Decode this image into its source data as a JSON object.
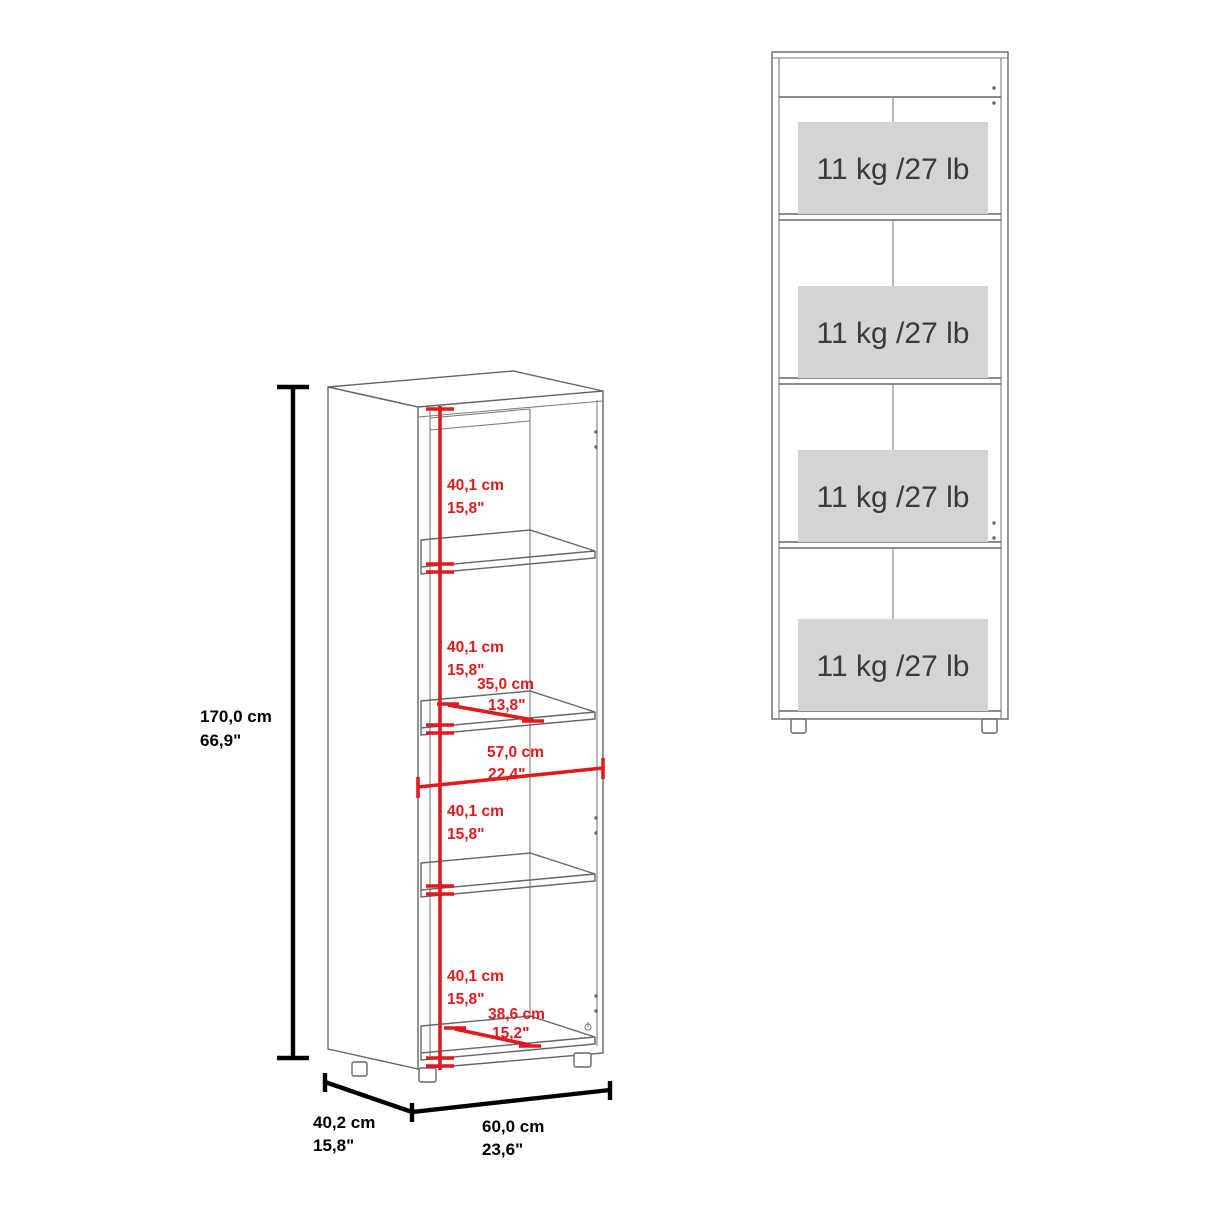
{
  "document": {
    "type": "furniture-dimension-diagram",
    "product": "4-shelf bookcase"
  },
  "colors": {
    "dimension_red": "#e2191d",
    "drawing_line_gray": "#63666a",
    "dimension_black": "#000000",
    "capacity_box_gray": "#d4d4d4",
    "capacity_text_gray": "#3a3a3a",
    "background": "#ffffff"
  },
  "iso": {
    "height_cm": "170,0 cm",
    "height_in": "66,9\"",
    "depth_cm": "40,2 cm",
    "depth_in": "15,8\"",
    "width_cm": "60,0 cm",
    "width_in": "23,6\"",
    "comp1_cm": "40,1 cm",
    "comp1_in": "15,8\"",
    "comp2_cm": "40,1 cm",
    "comp2_in": "15,8\"",
    "comp3_cm": "40,1 cm",
    "comp3_in": "15,8\"",
    "comp4_cm": "40,1 cm",
    "comp4_in": "15,8\"",
    "shelf_depth_cm": "35,0 cm",
    "shelf_depth_in": "13,8\"",
    "inner_width_cm": "57,0 cm",
    "inner_width_in": "22,4\"",
    "floor_depth_cm": "38,6 cm",
    "floor_depth_in": "15,2\""
  },
  "front": {
    "cap1": "11 kg /27 lb",
    "cap2": "11 kg /27 lb",
    "cap3": "11 kg /27 lb",
    "cap4": "11 kg /27 lb"
  }
}
